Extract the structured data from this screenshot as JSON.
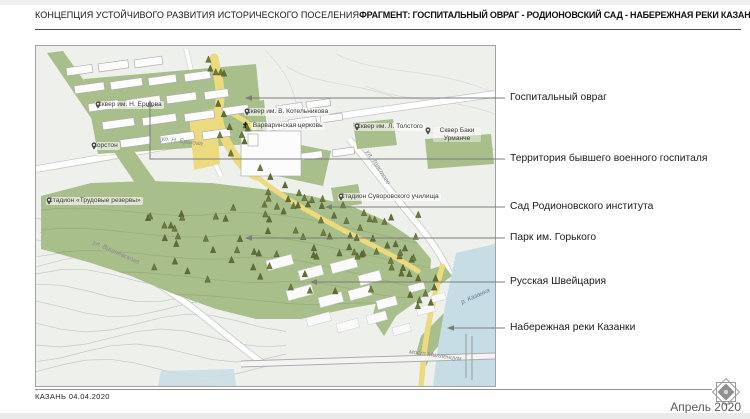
{
  "header": {
    "left_title": "КОНЦЕПЦИЯ УСТОЙЧИВОГО РАЗВИТИЯ ИСТОРИЧЕСКОГО ПОСЕЛЕНИЯ",
    "right_title": "ФРАГМЕНТ: ГОСПИТАЛЬНЫЙ ОВРАГ - РОДИОНОВСКИЙ САД - НАБЕРЕЖНАЯ РЕКИ КАЗАНКИ"
  },
  "map": {
    "poi_labels": [
      {
        "text": "Сквер им. Н. Ершова",
        "icon": "map-pin-icon"
      },
      {
        "text": "Корстон",
        "icon": "map-pin-icon"
      },
      {
        "text": "Сквер им. В. Котельникова",
        "icon": "map-pin-icon"
      },
      {
        "text": "Варваринская церковь",
        "icon": "church-cross-icon"
      },
      {
        "text": "Сквер им. Л. Толстого",
        "icon": "map-pin-icon"
      },
      {
        "text": "Сквер Баки Урманче",
        "icon": "map-pin-icon"
      },
      {
        "text": "Стадион Суворовского училища",
        "icon": "map-pin-icon"
      },
      {
        "text": "Стадион «Трудовые резервы»",
        "icon": "map-pin-icon"
      }
    ],
    "street_labels": [
      {
        "text": "ул. Н. Ершова"
      },
      {
        "text": "ул. Толстого"
      },
      {
        "text": "ул. Вишневского"
      },
      {
        "text": "р. Казанка"
      },
      {
        "text": "мост Миллениум"
      }
    ],
    "callouts": [
      {
        "text": "Госпитальный овраг"
      },
      {
        "text": "Территория бывшего военного госпиталя"
      },
      {
        "text": "Сад Родионовского института"
      },
      {
        "text": "Парк им. Горького"
      },
      {
        "text": "Русская Швейцария"
      },
      {
        "text": "Набережная реки Казанки"
      }
    ]
  },
  "footer": {
    "left_text": "КАЗАНЬ 04.04.2020",
    "right_text": "Апрель 2020"
  },
  "colors": {
    "green": "#a8be8b",
    "yellow": "#ecda7e",
    "river": "#c6dde5",
    "tree": "#5f6e38",
    "leader_line": "#7d7d7d"
  }
}
